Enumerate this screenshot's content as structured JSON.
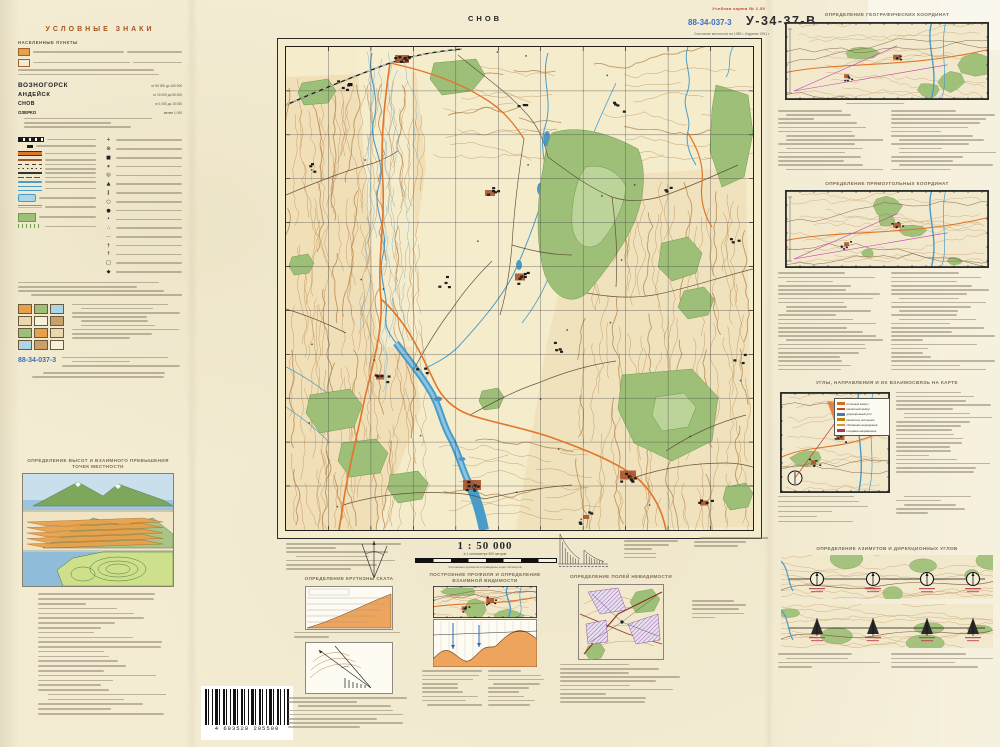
{
  "colors": {
    "paper": "#f3ecd3",
    "water": "#4a9cc8",
    "forest": "#9dbf77",
    "contour": "#b98a52",
    "road_orange": "#e0762a",
    "stamp_blue": "#3a6fc0",
    "label_red": "#c23b2e",
    "town_red": "#a8532c"
  },
  "header": {
    "red_label": "Учебная карта № 1-50",
    "stamp": "88-34-037-3",
    "sheet_code": "У-34-37-В",
    "map_name": "СНОВ",
    "status": "Состояние местности на 1985 г. Издание 1991 г."
  },
  "legend": {
    "title": "УСЛОВНЫЕ ЗНАКИ",
    "settlements_title": "НАСЕЛЕННЫЕ ПУНКТЫ",
    "towns": [
      {
        "name": "ВОЗНОГОРСК",
        "note": "от 50 000 до 100 000"
      },
      {
        "name": "АНДЕЙСК",
        "note": "от 10 000 до 50 000"
      },
      {
        "name": "СНОВ",
        "note": "от 1 000 до 10 000"
      },
      {
        "name": "ОЗЕРКО",
        "note": "менее 1 000"
      }
    ],
    "symbol_rows": [
      "railway-icon",
      "station-icon",
      "highway-icon",
      "improved-road-icon",
      "dirt-road-icon",
      "path-icon",
      "power-line-icon",
      "pipeline-icon",
      "river-icon",
      "canal-icon",
      "lake-icon",
      "swamp-icon",
      "forest-icon",
      "meadow-icon"
    ],
    "symbol_rows2": [
      "church-icon",
      "chapel-icon",
      "factory-icon",
      "windmill-icon",
      "water-tower-icon",
      "monument-icon",
      "bridge-icon",
      "spring-icon",
      "well-icon",
      "elevation-point-icon",
      "shrub-icon",
      "sand-icon",
      "cemetery-icon",
      "radio-mast-icon",
      "school-icon",
      "silo-icon"
    ],
    "stamp": "88-34-037-3"
  },
  "margin": {
    "scale": "1 : 50 000",
    "scale_sub": "в 1 сантиметре 500 метров",
    "contour_note": "Сплошные горизонтали проведены через 10 метров"
  },
  "sections": {
    "slope": "ОПРЕДЕЛЕНИЕ КРУТИЗНЫ СКАТА",
    "profile": "ПОСТРОЕНИЕ ПРОФИЛЯ И ОПРЕДЕЛЕНИЕ ВЗАИМНОЙ ВИДИМОСТИ",
    "invisibility": "ОПРЕДЕЛЕНИЕ ПОЛЕЙ НЕВИДИМОСТИ",
    "heights": "ОПРЕДЕЛЕНИЕ ВЫСОТ И ВЗАИМНОГО ПРЕВЫШЕНИЯ ТОЧЕК МЕСТНОСТИ",
    "geo": "ОПРЕДЕЛЕНИЕ ГЕОГРАФИЧЕСКИХ КООРДИНАТ",
    "rect": "ОПРЕДЕЛЕНИЕ ПРЯМОУГОЛЬНЫХ КООРДИНАТ",
    "angles": "УГЛЫ, НАПРАВЛЕНИЯ И ИХ ВЗАИМОСВЯЗЬ НА КАРТЕ",
    "azimuth": "ОПРЕДЕЛЕНИЕ АЗИМУТОВ И ДИРЕКЦИОННЫХ УГЛОВ"
  },
  "azimuth_legend": {
    "items": [
      {
        "label": "истинный азимут",
        "color": "#d86a20"
      },
      {
        "label": "магнитный азимут",
        "color": "#c04828"
      },
      {
        "label": "дирекционный угол",
        "color": "#4a78b0"
      },
      {
        "label": "магнитное склонение",
        "color": "#b8860b"
      },
      {
        "label": "сближение меридианов",
        "color": "#e09040"
      },
      {
        "label": "поправка направления",
        "color": "#b03848"
      }
    ]
  },
  "barcode": {
    "digits": "4 603528 205500"
  }
}
